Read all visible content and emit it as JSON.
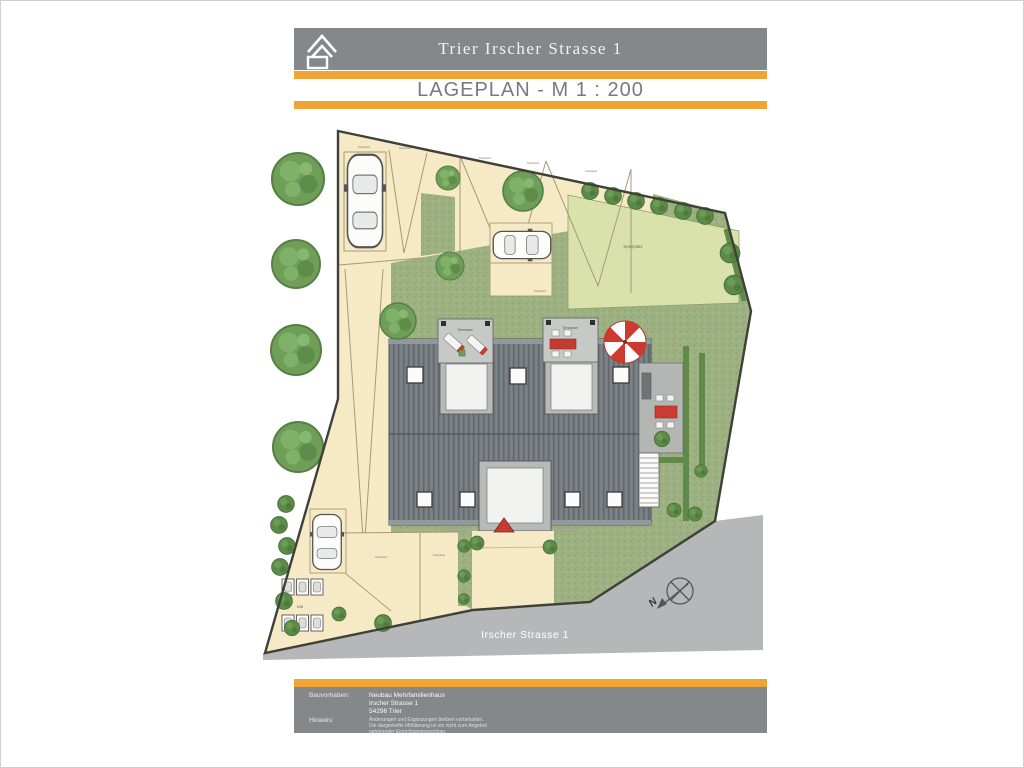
{
  "header": {
    "title": "Trier Irscher Strasse 1",
    "subtitle": "LAGEPLAN - M 1 : 200"
  },
  "plan": {
    "labels": {
      "terrace": "Terrasse",
      "lawn": "Spielplatz",
      "parking": "Stellplatz",
      "waste": "Müll",
      "road": "Irscher Strasse 1",
      "north": "N"
    }
  },
  "footer": {
    "project_label": "Bauvorhaben:",
    "project_lines": [
      "Neubau Mehrfamilienhaus",
      "Irscher Strasse 1",
      "54296 Trier"
    ],
    "note_label": "Hinweis:",
    "note_lines": [
      "Änderungen und Ergänzungen bleiben vorbehalten.",
      "Die dargestellte Möblierung ist ein nicht zum Angebot",
      "gehörender Einrichtungsvorschlag."
    ]
  },
  "colors": {
    "accent_orange": "#F0A434",
    "banner_gray": "#85888B",
    "roof_gray": "#71777C",
    "plot_beige": "#F6E9C5",
    "green": "#9DB183",
    "lawn_green": "#DAE2AB",
    "road_gray": "#B5B7B9",
    "furniture_red": "#C63B31"
  }
}
